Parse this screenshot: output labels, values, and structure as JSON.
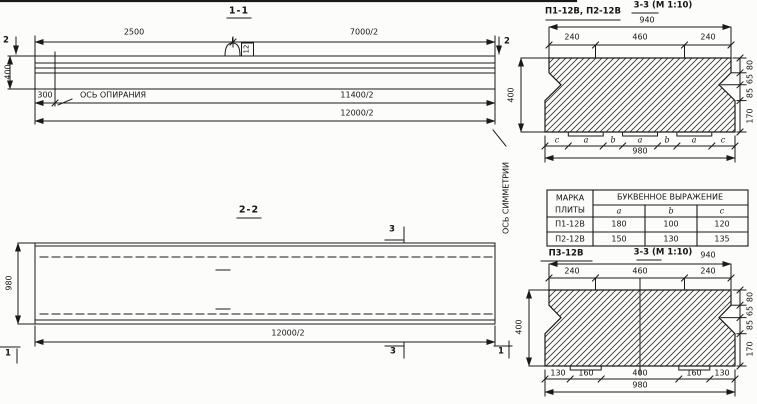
{
  "drawing": {
    "section11": {
      "title": "1-1",
      "dim_2500": "2500",
      "dim_7000": "7000/2",
      "dim_11400": "11400/2",
      "dim_12000": "12000/2",
      "dim_height": "400",
      "dim_300": "300",
      "support_axis_note": "ОСЬ ОПИРАНИЯ",
      "hook_mark": "12",
      "cut_left": "2",
      "cut_right": "2"
    },
    "section22": {
      "title": "2-2",
      "dim_width": "980",
      "dim_length": "12000/2",
      "symmetry_note": "ОСЬ СИММЕТРИИ",
      "cut3_top": "3",
      "cut3_bottom": "3",
      "cut1_left": "1",
      "cut1_right": "1"
    },
    "section33_top": {
      "label": "П1-12В, П2-12В",
      "title": "3-3 (М 1:10)",
      "dim_940": "940",
      "top_dims": [
        "240",
        "460",
        "240"
      ],
      "letters": [
        "c",
        "a",
        "b",
        "a",
        "b",
        "a",
        "c"
      ],
      "dim_980": "980",
      "dim_400": "400",
      "right_dims": [
        "80",
        "65",
        "85",
        "170"
      ]
    },
    "table": {
      "col1_header_line1": "МАРКА",
      "col1_header_line2": "ПЛИТЫ",
      "span_header": "БУКВЕННОЕ  ВЫРАЖЕНИЕ",
      "col_headers": [
        "a",
        "b",
        "c"
      ],
      "rows": [
        {
          "mark": "П1-12В",
          "a": "180",
          "b": "100",
          "c": "120"
        },
        {
          "mark": "П2-12В",
          "a": "150",
          "b": "130",
          "c": "135"
        }
      ]
    },
    "section33_bottom": {
      "label": "П3-12В",
      "title": "3-3 (М 1:10)",
      "dim_940": "940",
      "top_dims": [
        "240",
        "460",
        "240"
      ],
      "bottom_dims": [
        "130",
        "160",
        "400",
        "160",
        "130"
      ],
      "dim_980": "980",
      "dim_400": "400",
      "right_dims": [
        "80",
        "65",
        "85",
        "170"
      ]
    }
  }
}
